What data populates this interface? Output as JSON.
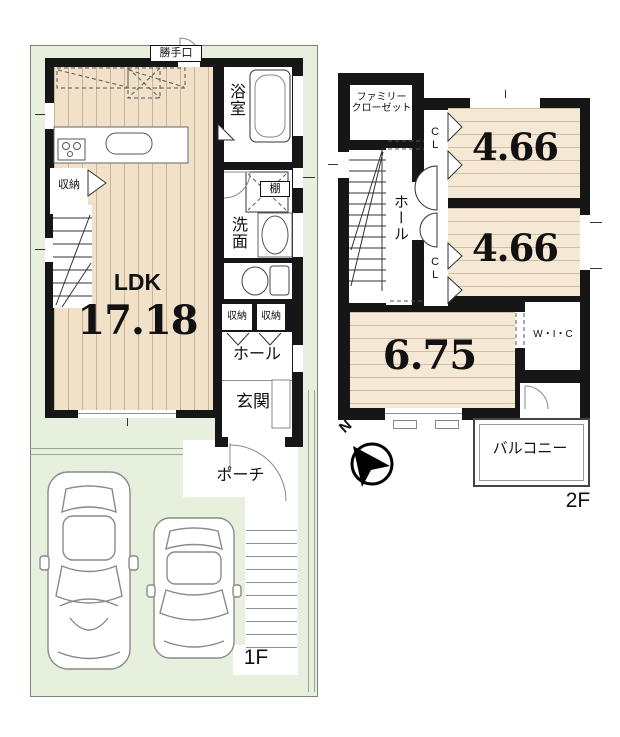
{
  "floor1": {
    "floor_label": "1F",
    "back_door": "勝手口",
    "bath": "浴室",
    "storage_left": "収納",
    "shelf": "棚",
    "washroom": "洗面",
    "ldk": "LDK",
    "ldk_area": "17.18",
    "storage_a": "収納",
    "storage_b": "収納",
    "hall": "ホール",
    "entrance": "玄関",
    "porch": "ポーチ"
  },
  "floor2": {
    "floor_label": "2F",
    "family_closet_line1": "ファミリー",
    "family_closet_line2": "クローゼット",
    "closet_a": "CL",
    "closet_b": "CL",
    "room_a_area": "4.66",
    "room_b_area": "4.66",
    "room_c_area": "6.75",
    "hall": "ホール",
    "walk_in_closet": "W・I・C",
    "balcony": "バルコニー",
    "compass_north": "N"
  },
  "colors": {
    "plot_green": "#e7efdd",
    "floor_wood_1f": "#f1e1c9",
    "floor_wood_2f": "#f5e9d5",
    "wall_black": "#161616"
  }
}
